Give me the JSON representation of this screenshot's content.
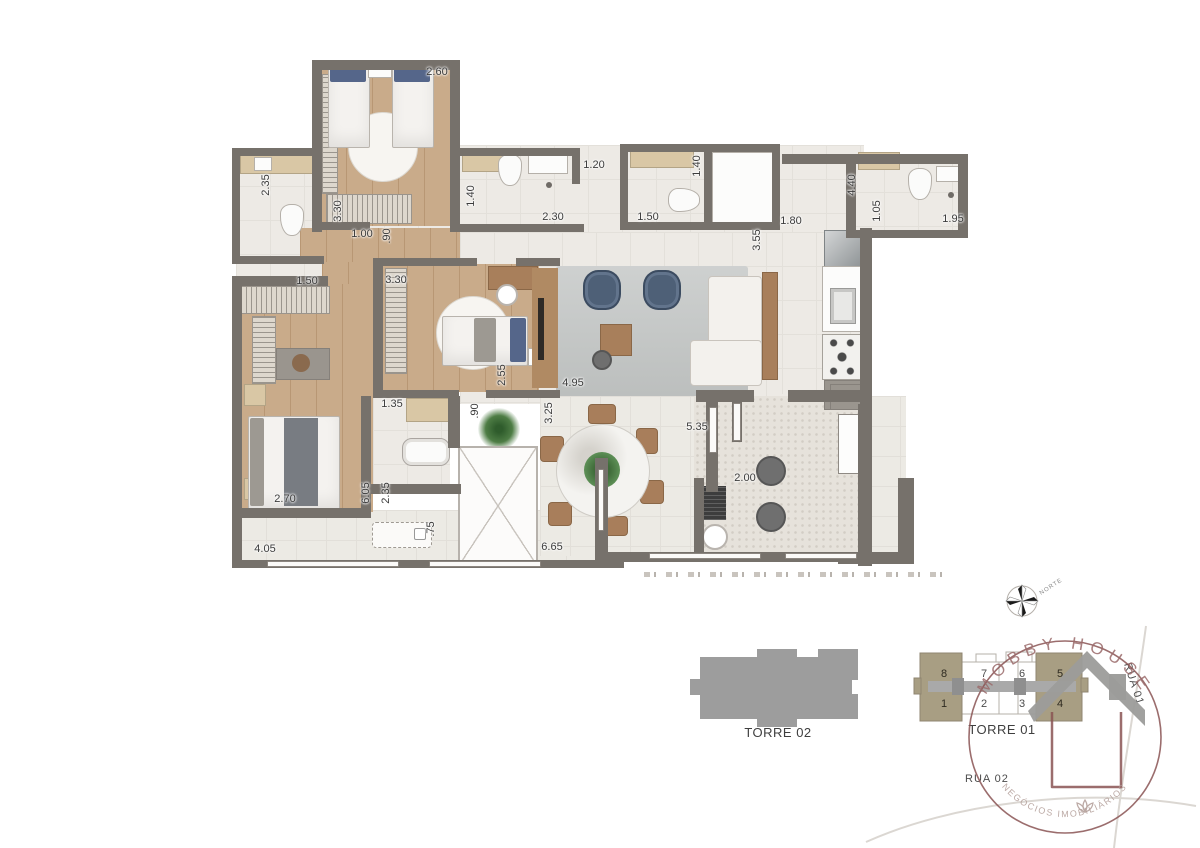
{
  "floorplan": {
    "dimensions": [
      {
        "label": "2.60",
        "x": 437,
        "y": 72,
        "rot": 0
      },
      {
        "label": "2.35",
        "x": 266,
        "y": 185,
        "rot": 90
      },
      {
        "label": "3.30",
        "x": 338,
        "y": 211,
        "rot": 90
      },
      {
        "label": "1.00",
        "x": 362,
        "y": 234,
        "rot": 0
      },
      {
        "label": ".90",
        "x": 387,
        "y": 236,
        "rot": 90
      },
      {
        "label": "1.50",
        "x": 307,
        "y": 281,
        "rot": 0
      },
      {
        "label": "1.40",
        "x": 471,
        "y": 196,
        "rot": 90
      },
      {
        "label": "2.30",
        "x": 553,
        "y": 217,
        "rot": 0
      },
      {
        "label": "1.20",
        "x": 594,
        "y": 165,
        "rot": 0
      },
      {
        "label": "1.50",
        "x": 648,
        "y": 217,
        "rot": 0
      },
      {
        "label": "1.40",
        "x": 697,
        "y": 166,
        "rot": 90
      },
      {
        "label": "1.80",
        "x": 791,
        "y": 221,
        "rot": 0
      },
      {
        "label": "3.55",
        "x": 757,
        "y": 240,
        "rot": 90
      },
      {
        "label": "4.40",
        "x": 852,
        "y": 185,
        "rot": 90
      },
      {
        "label": "1.05",
        "x": 877,
        "y": 211,
        "rot": 90
      },
      {
        "label": "1.95",
        "x": 953,
        "y": 219,
        "rot": 0
      },
      {
        "label": "3.30",
        "x": 396,
        "y": 280,
        "rot": 0
      },
      {
        "label": "2.55",
        "x": 502,
        "y": 375,
        "rot": 90
      },
      {
        "label": "4.95",
        "x": 573,
        "y": 383,
        "rot": 0
      },
      {
        "label": "3.25",
        "x": 549,
        "y": 413,
        "rot": 90
      },
      {
        "label": "1.35",
        "x": 392,
        "y": 404,
        "rot": 0
      },
      {
        "label": ".90",
        "x": 475,
        "y": 411,
        "rot": 90
      },
      {
        "label": "5.35",
        "x": 697,
        "y": 427,
        "rot": 0
      },
      {
        "label": "2.00",
        "x": 745,
        "y": 478,
        "rot": 0
      },
      {
        "label": "6.05",
        "x": 366,
        "y": 493,
        "rot": 90
      },
      {
        "label": "2.35",
        "x": 386,
        "y": 493,
        "rot": 90
      },
      {
        "label": ".75",
        "x": 431,
        "y": 529,
        "rot": 90
      },
      {
        "label": "2.70",
        "x": 285,
        "y": 499,
        "rot": 0
      },
      {
        "label": "4.05",
        "x": 265,
        "y": 549,
        "rot": 0
      },
      {
        "label": "6.65",
        "x": 552,
        "y": 547,
        "rot": 0
      }
    ]
  },
  "siteplan": {
    "torre02": {
      "label": "TORRE 02"
    },
    "torre01": {
      "label": "TORRE 01",
      "units": [
        {
          "num": "8",
          "highlighted": true
        },
        {
          "num": "7",
          "highlighted": false
        },
        {
          "num": "6",
          "highlighted": false
        },
        {
          "num": "5",
          "highlighted": true
        },
        {
          "num": "1",
          "highlighted": true
        },
        {
          "num": "2",
          "highlighted": false
        },
        {
          "num": "3",
          "highlighted": false
        },
        {
          "num": "4",
          "highlighted": true
        }
      ]
    },
    "streets": {
      "rua01": "RUA 01",
      "rua02": "RUA 02"
    },
    "compass_label": "NORTE"
  },
  "watermark": {
    "name_arc": "MOBBY HOUSE",
    "tagline_arc": "NEGÓCIOS IMOBILIÁRIOS"
  },
  "colors": {
    "wall": "#76716b",
    "wood": "#c9ab8a",
    "tile": "#edeae5",
    "rug": "#c6c9c8",
    "highlight_unit": "#a89e83",
    "tower_gray": "#9d9d9d",
    "logo": "#8a5454",
    "road": "#dbd7d2"
  }
}
